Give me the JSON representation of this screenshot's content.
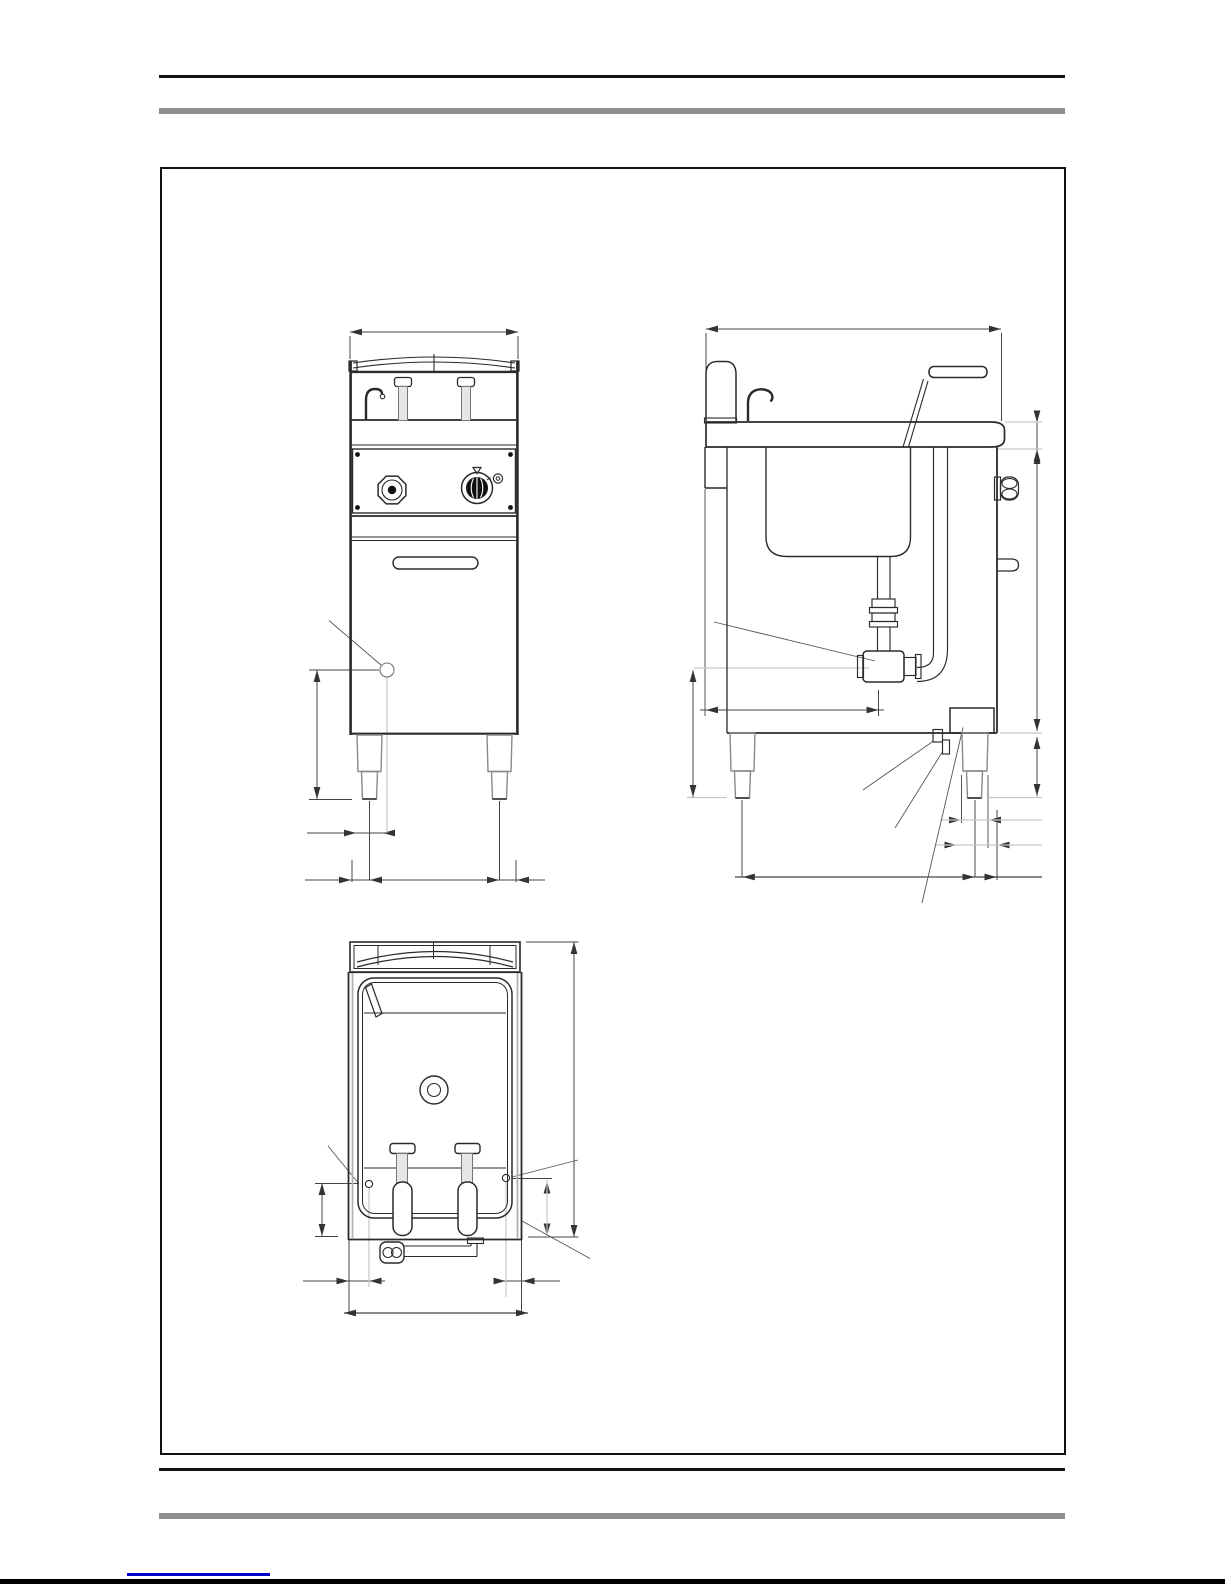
{
  "page": {
    "background_color": "#ffffff",
    "header": {
      "rule_color": "#111111",
      "band_color": "#8f8f8f"
    },
    "footer": {
      "rule_color": "#111111",
      "band_color": "#8f8f8f",
      "bottom_bar_color": "#000000",
      "link_underline_color": "#0000cc",
      "link_text": ""
    }
  },
  "drawing": {
    "frame_border_color": "#111111",
    "title": "",
    "views": [
      {
        "id": "front-view",
        "label": "Front elevation view of floor-standing cooker unit with control knobs, door and legs, with unlabelled dimension lines"
      },
      {
        "id": "side-view",
        "label": "Side elevation view showing well, basket handle, drain piping, rating plate and connections, with unlabelled dimension lines"
      },
      {
        "id": "top-view",
        "label": "Top plan view showing well, drain hole, basket handles and bottom service connections, with unlabelled dimension lines"
      }
    ],
    "stroke_colors": {
      "primary": "#2a2a2a",
      "dimension": "#444444",
      "secondary_gray": "#8a8a8a",
      "extension_gray": "#c6c6c6"
    },
    "annotations": {
      "dimension_values_visible": false,
      "text_labels_visible": false
    }
  }
}
